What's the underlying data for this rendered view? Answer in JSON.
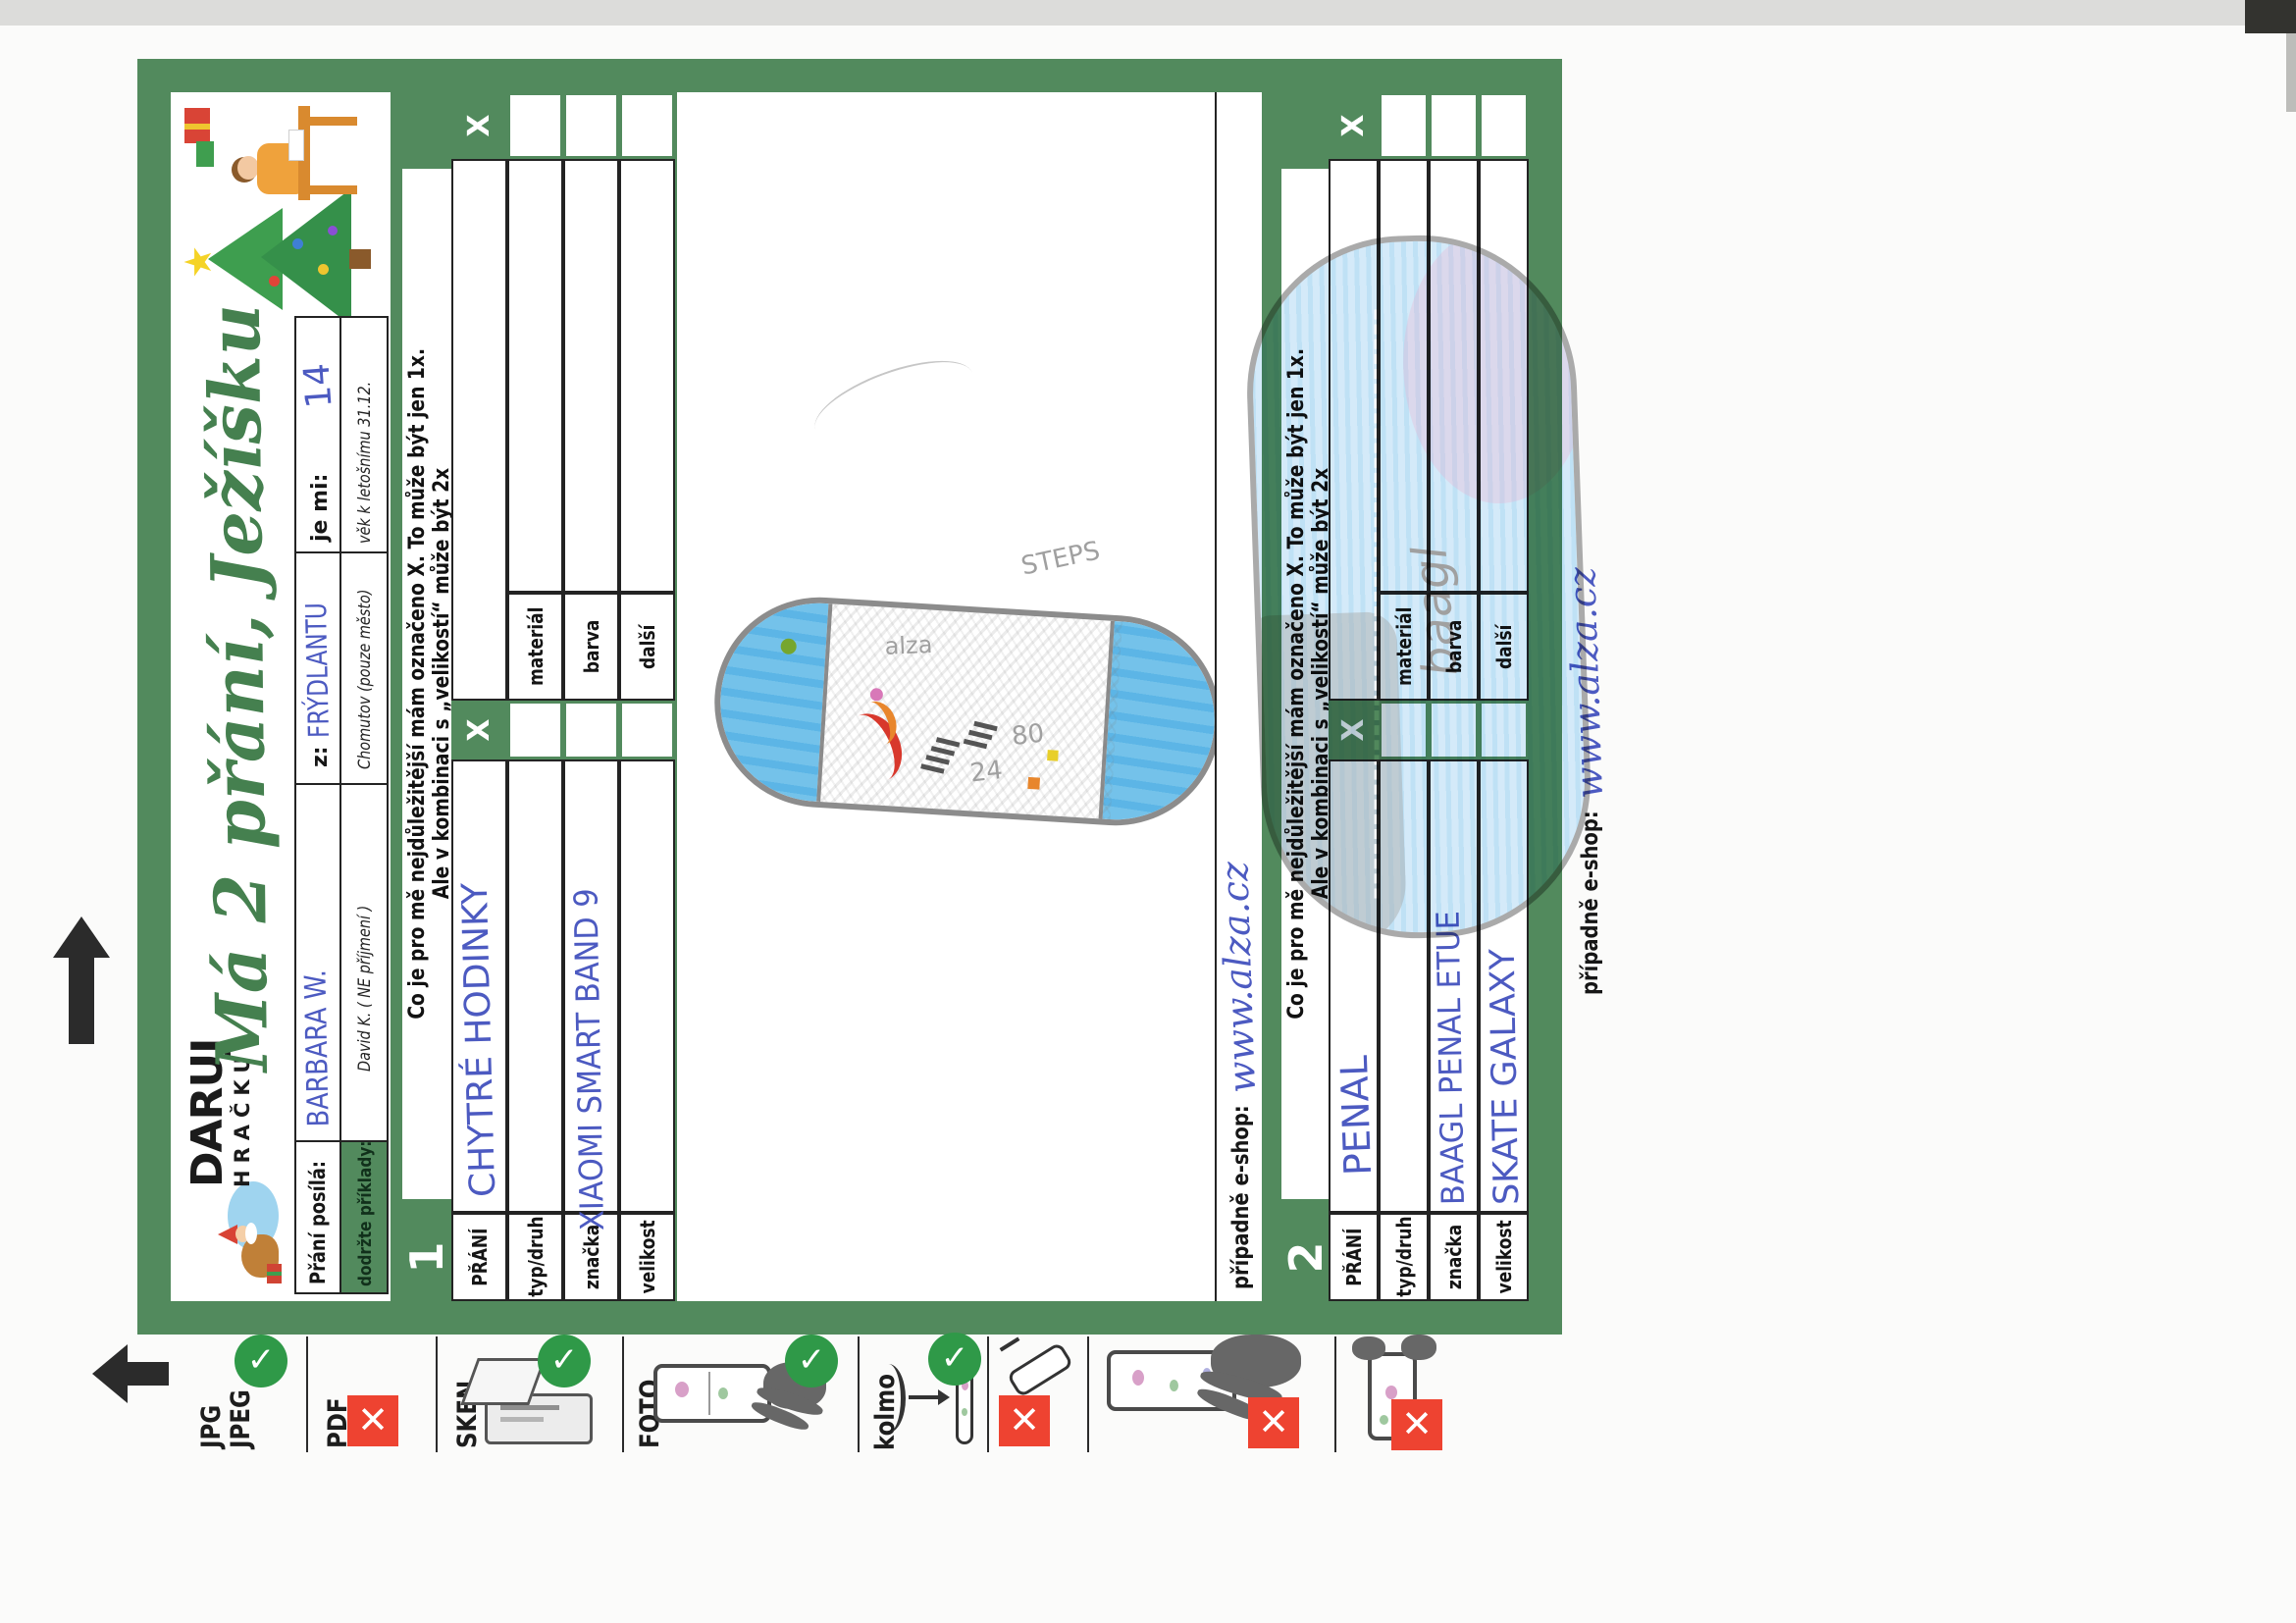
{
  "page": {
    "bg": "#fbfbfa",
    "accent_green": "#528a5d",
    "check_green": "#2f9948",
    "cross_red": "#ee4331",
    "ink_blue": "#4c5ac1"
  },
  "logo": {
    "line1": "DARUJ",
    "line2": "HRAČKU"
  },
  "title": "Má 2 přání, Ježíšku",
  "header": {
    "sender_label": "Přání posílá:",
    "sender_value": "BARBARA W.",
    "from_label": "z:",
    "from_value": "FRÝDLANTU",
    "age_label": "je mi:",
    "age_value": "14",
    "examples_label": "dodržte příklady:",
    "example_name": "David K. ( NE příjmení )",
    "example_city": "Chomutov (pouze město)",
    "example_age": "věk k letošnímu 31.12."
  },
  "instructions": {
    "line1": "Co je pro mě nejdůležitější mám označeno X.  To může být jen 1x.",
    "line2": "Ale v kombinaci s „velikostí“ může být 2x"
  },
  "sections": [
    {
      "number": "1",
      "x_mark": "X",
      "rows": [
        {
          "label": "PŘÁNÍ",
          "value": "CHYTRÉ HODINKY",
          "label2": "",
          "value2": ""
        },
        {
          "label": "typ/druh",
          "value": "",
          "label2": "materiál",
          "value2": ""
        },
        {
          "label": "značka",
          "value": "XIAOMI SMART BAND 9",
          "label2": "barva",
          "value2": ""
        },
        {
          "label": "velikost",
          "value": "",
          "label2": "další",
          "value2": ""
        }
      ],
      "eshop_label": "případně e-shop:",
      "eshop_value": "www.alza.cz",
      "drawing": {
        "kind": "smartwatch-crayon-sketch",
        "texts": {
          "steps": "STEPS",
          "brand": "alza",
          "num1": "24",
          "num2": "80"
        }
      }
    },
    {
      "number": "2",
      "x_mark": "X",
      "rows": [
        {
          "label": "PŘÁNÍ",
          "value": "PENAL",
          "label2": "",
          "value2": ""
        },
        {
          "label": "typ/druh",
          "value": "",
          "label2": "materiál",
          "value2": ""
        },
        {
          "label": "značka",
          "value": "BAAGL PENAL ETUE",
          "label2": "barva",
          "value2": ""
        },
        {
          "label": "velikost",
          "value": "SKATE GALAXY",
          "label2": "další",
          "value2": ""
        }
      ],
      "eshop_label": "případně e-shop:",
      "eshop_value": "www.alza.cz",
      "drawing": {
        "kind": "pencil-case-crayon-sketch",
        "texts": {
          "brand": "baagl"
        }
      }
    }
  ],
  "strip": {
    "arrow_icon": "black-up-arrow",
    "margin_arrow_icon": "black-up-arrow",
    "icons": {
      "check": "✓",
      "cross": "✕"
    },
    "items": [
      {
        "id": "jpg",
        "label1": "JPG",
        "label2": "JPEG",
        "status": "ok"
      },
      {
        "id": "pdf",
        "label1": "PDF",
        "status": "no"
      },
      {
        "id": "sken",
        "label1": "SKEN",
        "status": "ok"
      },
      {
        "id": "foto",
        "label1": "FOTO",
        "status": "ok"
      },
      {
        "id": "kolmo",
        "label1": "kolmo",
        "status": "ok"
      },
      {
        "id": "angled-phone",
        "status": "no"
      },
      {
        "id": "hand-phone",
        "status": "no"
      },
      {
        "id": "portrait-phone",
        "status": "no"
      }
    ]
  }
}
